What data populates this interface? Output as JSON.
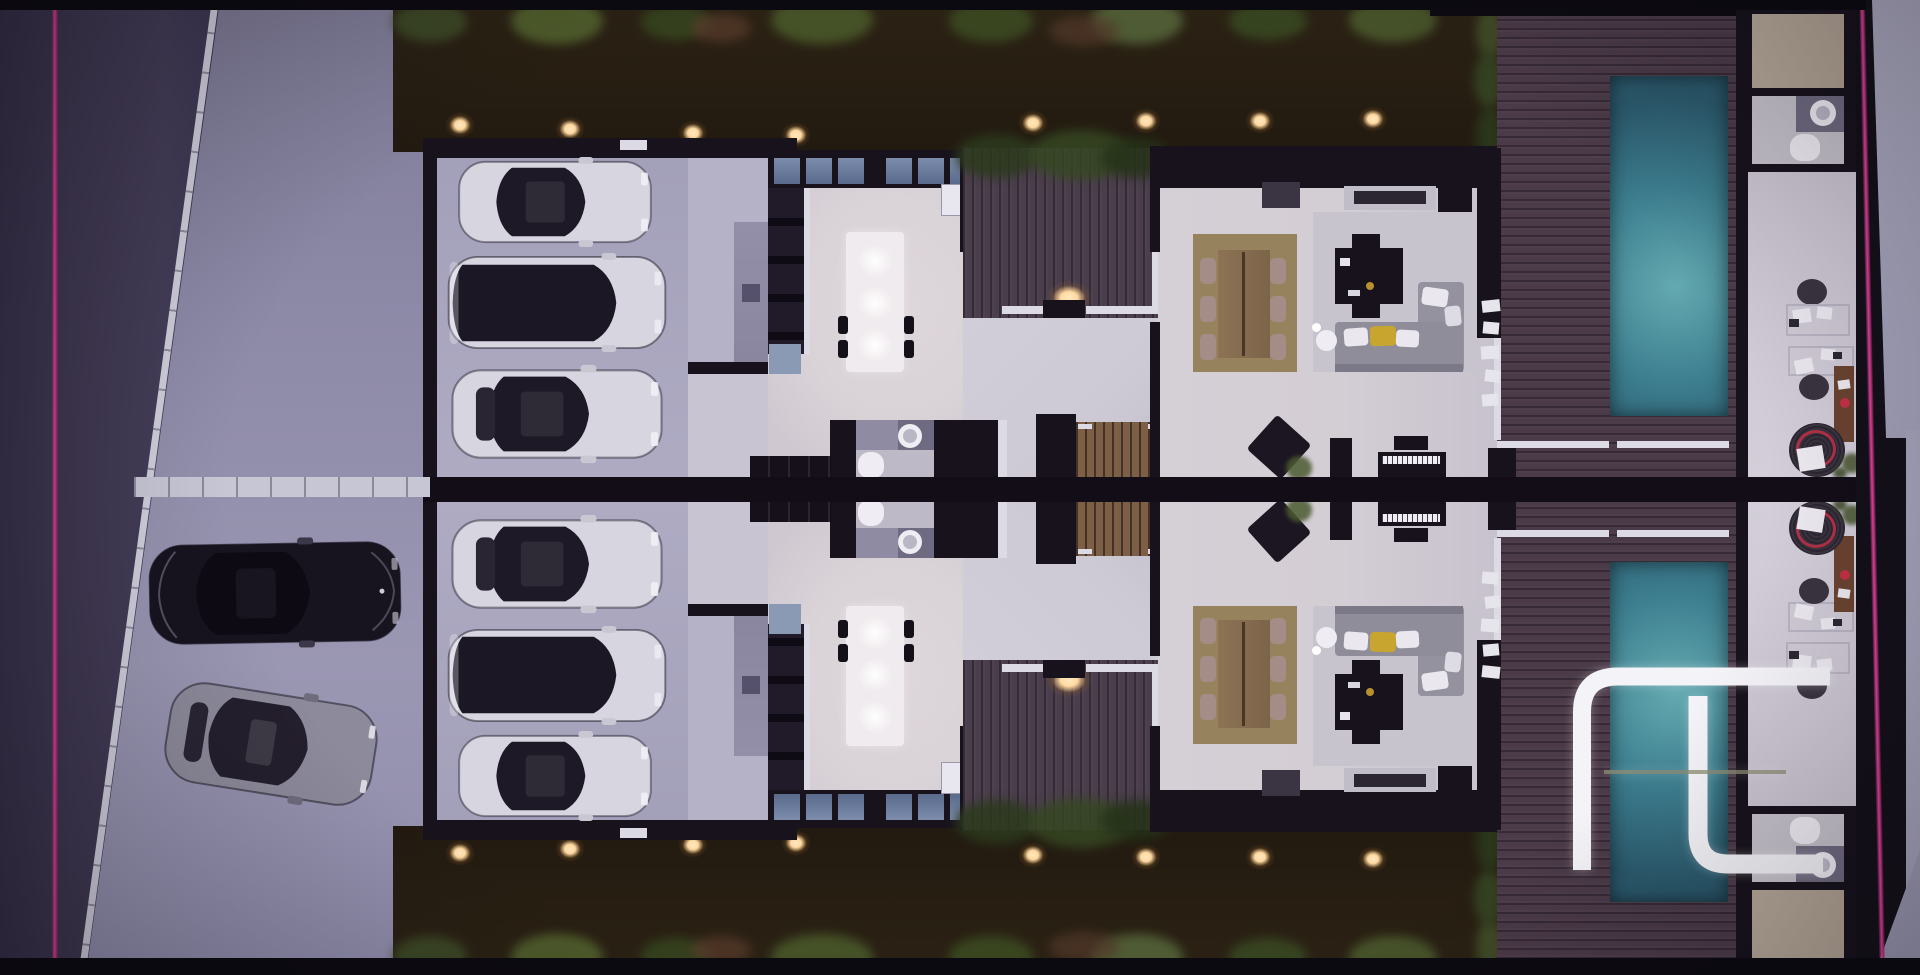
{
  "scene": {
    "type": "3d-floor-plan-render",
    "view": "top-down aerial, night lighting",
    "description": "Mirrored duplex residence: street and driveway at left, two garages with three cars each, kitchens with lit islands, stair halls, living-dining rooms, wood pool terraces with teal pools, office wing at right, landscaped strips with path lights",
    "units": [
      {
        "id": "upper-unit",
        "rooms": [
          "garage",
          "patio",
          "kitchen",
          "bathroom",
          "hallway",
          "stairs",
          "deck-walkway",
          "living-dining",
          "pool-terrace",
          "storage-room",
          "office",
          "wc"
        ]
      },
      {
        "id": "lower-unit",
        "mirrored": true,
        "rooms": [
          "garage",
          "patio",
          "kitchen",
          "bathroom",
          "hallway",
          "stairs",
          "deck-walkway",
          "living-dining",
          "pool-terrace",
          "storage-room",
          "office",
          "wc"
        ]
      }
    ],
    "counts": {
      "garage_cars_per_unit": 3,
      "street_cars": 2,
      "pools": 2,
      "garden_lights_per_strip": 8,
      "dining_chairs_per_unit": 6,
      "kitchen_island_lights": 3
    },
    "street": {
      "curb": "diagonal concrete curb with joints",
      "center_walkway": "concrete path at mirror axis"
    },
    "boundary_lines": {
      "left": "vertical magenta property line",
      "right": "slightly slanted magenta property line"
    },
    "cars": {
      "street": [
        "black sedan",
        "gray sedan (angled)"
      ],
      "garage": [
        "white sedan",
        "dark suv with white hood",
        "white sedan"
      ]
    }
  },
  "palette": {
    "bg": "#0c0a11",
    "wall": "#17121c",
    "band": "#120d17",
    "road": "#3e3750",
    "driveway": "#8f8cab",
    "curb": "#cfcedb",
    "pink": "#e03e96",
    "pink_dim": "#9c2766",
    "garden": "#271e12",
    "foliage": "#46542c",
    "light_warm": "#ffd9a0",
    "garage_floor": "#a8a5be",
    "kitchen_floor": "#d9d3d8",
    "living_floor": "#d5cfd6",
    "hall_floor": "#cdc9d5",
    "office_floor": "#cac5d1",
    "bath_floor": "#bdb9c7",
    "patio": "#b5b2c8",
    "island": "#f0ebee",
    "trim": "#dcdae4",
    "rug_dining": "#96825d",
    "rug_living": "#c8c4ce",
    "wood_table": "#8a6f50",
    "chair_taupe": "#a38d86",
    "sofa": "#8f8d99",
    "pillow": "#eae8ee",
    "pillow_yellow": "#c7a52e",
    "deck_walk": "#4a3d4c",
    "pool_deck": "#4b3a48",
    "pool_edge": "#2b5a6d",
    "pool_glow": "#64aab1",
    "stair_wood": "#7d5f46",
    "beige_room": "#b1a394",
    "vanity": "#6f6a80",
    "porcelain": "#efedf3",
    "daybed": "#342d38",
    "daybed_red": "#b23046",
    "brown_wood": "#6a4330",
    "car_white": "#d7d5df",
    "car_dark": "#1b1724",
    "car_gray": "#8d8a9b",
    "car_black": "#17131f",
    "glass": "#1d1926",
    "logo_white": "#f4f3f7",
    "logo_crossbar": "#8d8d74"
  },
  "logo": {
    "kind": "white monogram watermark",
    "strokes": 2,
    "crossbar": true,
    "position": "bottom-right over lower pool"
  }
}
